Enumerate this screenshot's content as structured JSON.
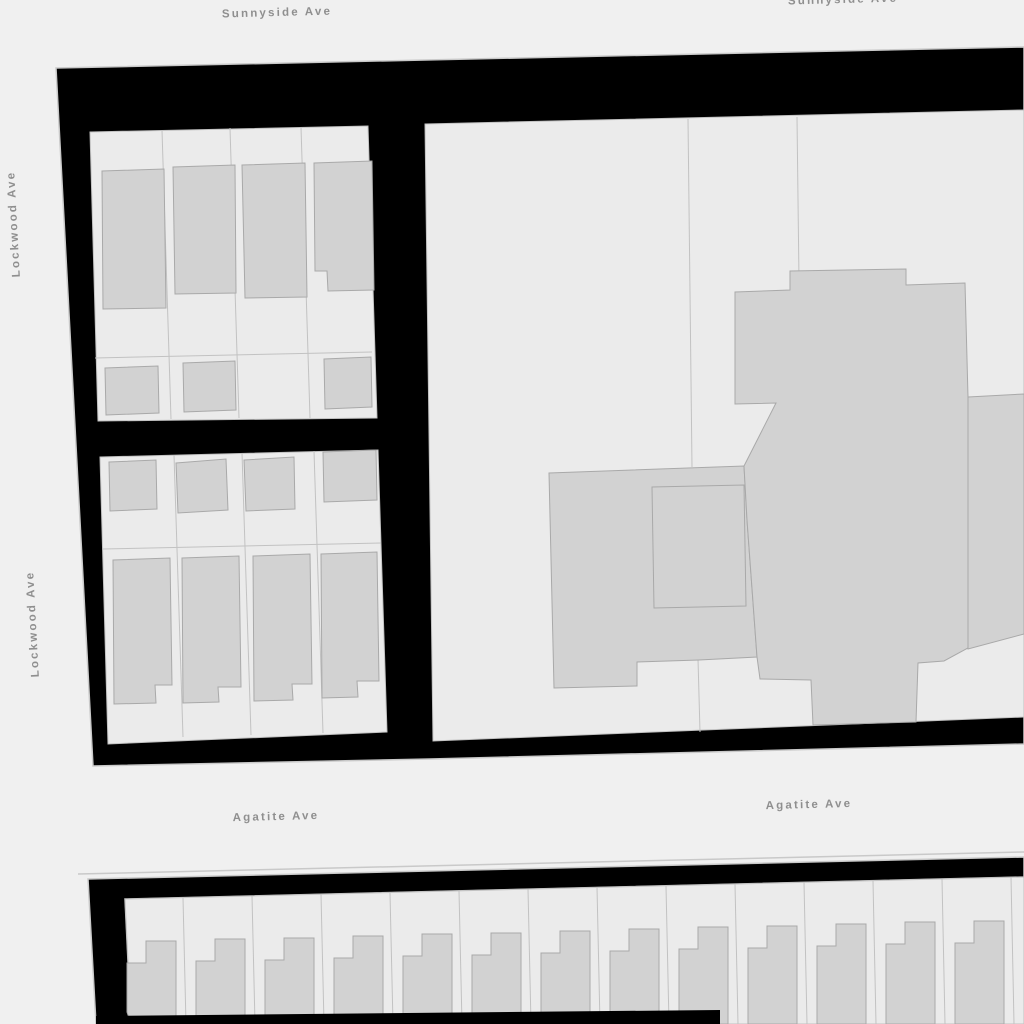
{
  "map": {
    "width": 1024,
    "height": 1024,
    "colors": {
      "background": "#f0f0f0",
      "block_fill": "#000000",
      "block_hairline": "#c9c9c9",
      "parcel_fill": "#ebebeb",
      "parcel_line": "#c2c2c2",
      "building_fill": "#d2d2d2",
      "building_line": "#a9a9a9",
      "label_text": "#8f8f8f",
      "label_halo": "#f0f0f0"
    },
    "styles": {
      "block": {
        "fill": "#000000",
        "stroke": "#c9c9c9",
        "sw": 1.5,
        "click": "true"
      },
      "strip": {
        "fill": "#000000",
        "stroke": "none",
        "sw": 0,
        "click": "false"
      },
      "parcelArea": {
        "fill": "#ebebeb",
        "stroke": "#c2c2c2",
        "sw": 1,
        "click": "true"
      },
      "parcelLine": {
        "fill": "none",
        "stroke": "#c2c2c2",
        "sw": 1,
        "click": "false"
      },
      "building": {
        "fill": "#d2d2d2",
        "stroke": "#a9a9a9",
        "sw": 1,
        "click": "true"
      },
      "buildingInner": {
        "fill": "none",
        "stroke": "#a9a9a9",
        "sw": 1,
        "click": "false"
      },
      "hairline": {
        "fill": "none",
        "stroke": "#c9c9c9",
        "sw": 1.5,
        "click": "false"
      }
    },
    "street_labels": [
      {
        "text": "Sunnyside Ave",
        "x": 277,
        "y": 13,
        "rotate": -1.5
      },
      {
        "text": "Sunnyside Ave",
        "x": 843,
        "y": 0,
        "rotate": -1.5
      },
      {
        "text": "Lockwood Ave",
        "x": 14,
        "y": 224,
        "rotate": -93
      },
      {
        "text": "Lockwood Ave",
        "x": 33,
        "y": 624,
        "rotate": -93
      },
      {
        "text": "Agatite Ave",
        "x": 276,
        "y": 817,
        "rotate": -1.5
      },
      {
        "text": "Agatite Ave",
        "x": 809,
        "y": 805,
        "rotate": -1.5
      }
    ],
    "layers": [
      {
        "type": "polygon",
        "role": "block",
        "name": "city-block-north",
        "points": "56,68 1024,47 1024,744 430,759 93,766"
      },
      {
        "type": "polygon",
        "role": "parcelArea",
        "name": "parcel-grid-nw-upper",
        "points": "90,132 368,126 377,418 98,421"
      },
      {
        "type": "polygon",
        "role": "parcelArea",
        "name": "parcel-grid-nw-lower",
        "points": "100,457 378,450 387,732 108,744"
      },
      {
        "type": "polygon",
        "role": "parcelArea",
        "name": "parcel-grid-ne",
        "points": "425,124 1024,110 1024,717 433,741"
      },
      {
        "type": "line",
        "role": "parcelLine",
        "name": "parcel-line",
        "x1": 162,
        "y1": 130,
        "x2": 171,
        "y2": 419
      },
      {
        "type": "line",
        "role": "parcelLine",
        "name": "parcel-line",
        "x1": 230,
        "y1": 128,
        "x2": 239,
        "y2": 418
      },
      {
        "type": "line",
        "role": "parcelLine",
        "name": "parcel-line",
        "x1": 301,
        "y1": 127,
        "x2": 310,
        "y2": 418
      },
      {
        "type": "line",
        "role": "parcelLine",
        "name": "parcel-line",
        "x1": 95,
        "y1": 358,
        "x2": 372,
        "y2": 352
      },
      {
        "type": "line",
        "role": "parcelLine",
        "name": "parcel-line",
        "x1": 174,
        "y1": 455,
        "x2": 183,
        "y2": 737
      },
      {
        "type": "line",
        "role": "parcelLine",
        "name": "parcel-line",
        "x1": 242,
        "y1": 453,
        "x2": 251,
        "y2": 735
      },
      {
        "type": "line",
        "role": "parcelLine",
        "name": "parcel-line",
        "x1": 314,
        "y1": 451,
        "x2": 323,
        "y2": 733
      },
      {
        "type": "line",
        "role": "parcelLine",
        "name": "parcel-line",
        "x1": 103,
        "y1": 549,
        "x2": 381,
        "y2": 543
      },
      {
        "type": "line",
        "role": "parcelLine",
        "name": "parcel-line",
        "x1": 688,
        "y1": 119,
        "x2": 692,
        "y2": 467
      },
      {
        "type": "line",
        "role": "parcelLine",
        "name": "parcel-line",
        "x1": 797,
        "y1": 117,
        "x2": 799,
        "y2": 281
      },
      {
        "type": "line",
        "role": "parcelLine",
        "name": "parcel-line",
        "x1": 698,
        "y1": 659,
        "x2": 700,
        "y2": 732
      },
      {
        "type": "polygon",
        "role": "building",
        "name": "building-footprint",
        "points": "102,171 164,169 166,308 103,309"
      },
      {
        "type": "polygon",
        "role": "building",
        "name": "building-footprint",
        "points": "173,167 235,165 236,293 175,294"
      },
      {
        "type": "polygon",
        "role": "building",
        "name": "building-footprint",
        "points": "242,165 305,163 307,297 245,298"
      },
      {
        "type": "polygon",
        "role": "building",
        "name": "building-footprint",
        "points": "314,163 372,161 374,290 328,291 327,271 315,271"
      },
      {
        "type": "polygon",
        "role": "building",
        "name": "garage-footprint",
        "points": "105,368 158,366 159,413 106,415"
      },
      {
        "type": "polygon",
        "role": "building",
        "name": "garage-footprint",
        "points": "183,363 235,361 236,410 184,412"
      },
      {
        "type": "polygon",
        "role": "building",
        "name": "garage-footprint",
        "points": "324,359 371,357 372,407 325,409"
      },
      {
        "type": "polygon",
        "role": "building",
        "name": "garage-footprint",
        "points": "109,462 156,460 157,509 110,511"
      },
      {
        "type": "polygon",
        "role": "building",
        "name": "garage-footprint",
        "points": "176,463 226,459 228,510 178,513"
      },
      {
        "type": "polygon",
        "role": "building",
        "name": "garage-footprint",
        "points": "244,460 294,457 295,509 246,511"
      },
      {
        "type": "polygon",
        "role": "building",
        "name": "garage-footprint",
        "points": "323,452 376,450 377,500 324,502"
      },
      {
        "type": "polygon",
        "role": "building",
        "name": "building-footprint",
        "points": "113,560 170,558 172,685 155,685 156,703 114,704"
      },
      {
        "type": "polygon",
        "role": "building",
        "name": "building-footprint",
        "points": "182,558 239,556 241,687 218,687 219,702 183,703"
      },
      {
        "type": "polygon",
        "role": "building",
        "name": "building-footprint",
        "points": "253,556 310,554 312,684 292,684 293,700 254,701"
      },
      {
        "type": "polygon",
        "role": "building",
        "name": "building-footprint",
        "points": "321,554 377,552 379,681 357,681 358,697 322,698"
      },
      {
        "type": "polygon",
        "role": "building",
        "name": "building-footprint-courtyard",
        "points": "549,473 744,466 747,520 757,657 699,660 637,662 637,686 554,688"
      },
      {
        "type": "polygon",
        "role": "building",
        "name": "building-footprint-large",
        "points": "735,292 790,290 790,271 906,269 906,285 965,283 968,397 968,648 944,661 918,663 916,722 813,725 811,680 760,679 757,657 747,520 744,466 776,403 735,404"
      },
      {
        "type": "polygon",
        "role": "building",
        "name": "building-footprint-wing",
        "points": "968,397 1024,394 1024,634 968,649"
      },
      {
        "type": "polygon",
        "role": "buildingInner",
        "name": "building-courtyard-outline",
        "points": "652,487 744,485 746,606 654,608"
      },
      {
        "type": "line",
        "role": "hairline",
        "name": "block-edge-hairline",
        "x1": 78,
        "y1": 874,
        "x2": 1024,
        "y2": 852
      },
      {
        "type": "polygon",
        "role": "block",
        "name": "city-block-south",
        "points": "88,879 1024,857 1024,877 125,899 131,1024 96,1024"
      },
      {
        "type": "polygon",
        "role": "parcelArea",
        "name": "parcel-row-south",
        "points": "125,899 1024,877 1024,1024 131,1024"
      },
      {
        "type": "line",
        "role": "parcelLine",
        "name": "parcel-line",
        "x1": 183,
        "y1": 898,
        "x2": 186,
        "y2": 1024
      },
      {
        "type": "line",
        "role": "parcelLine",
        "name": "parcel-line",
        "x1": 252,
        "y1": 896,
        "x2": 255,
        "y2": 1024
      },
      {
        "type": "line",
        "role": "parcelLine",
        "name": "parcel-line",
        "x1": 321,
        "y1": 894,
        "x2": 324,
        "y2": 1024
      },
      {
        "type": "line",
        "role": "parcelLine",
        "name": "parcel-line",
        "x1": 390,
        "y1": 893,
        "x2": 393,
        "y2": 1024
      },
      {
        "type": "line",
        "role": "parcelLine",
        "name": "parcel-line",
        "x1": 459,
        "y1": 891,
        "x2": 462,
        "y2": 1024
      },
      {
        "type": "line",
        "role": "parcelLine",
        "name": "parcel-line",
        "x1": 528,
        "y1": 889,
        "x2": 531,
        "y2": 1024
      },
      {
        "type": "line",
        "role": "parcelLine",
        "name": "parcel-line",
        "x1": 597,
        "y1": 887,
        "x2": 600,
        "y2": 1024
      },
      {
        "type": "line",
        "role": "parcelLine",
        "name": "parcel-line",
        "x1": 666,
        "y1": 886,
        "x2": 669,
        "y2": 1024
      },
      {
        "type": "line",
        "role": "parcelLine",
        "name": "parcel-line",
        "x1": 735,
        "y1": 884,
        "x2": 738,
        "y2": 1024
      },
      {
        "type": "line",
        "role": "parcelLine",
        "name": "parcel-line",
        "x1": 804,
        "y1": 882,
        "x2": 807,
        "y2": 1024
      },
      {
        "type": "line",
        "role": "parcelLine",
        "name": "parcel-line",
        "x1": 873,
        "y1": 881,
        "x2": 876,
        "y2": 1024
      },
      {
        "type": "line",
        "role": "parcelLine",
        "name": "parcel-line",
        "x1": 942,
        "y1": 879,
        "x2": 945,
        "y2": 1024
      },
      {
        "type": "line",
        "role": "parcelLine",
        "name": "parcel-line",
        "x1": 1011,
        "y1": 877,
        "x2": 1014,
        "y2": 1024
      },
      {
        "type": "polygon",
        "role": "building",
        "name": "building-footprint",
        "points": "127,963 146,963 146,941 176,941 176,1024 131,1024 127,1012"
      },
      {
        "type": "polygon",
        "role": "building",
        "name": "building-footprint",
        "points": "196,961 215,961 215,939 245,939 245,1024 196,1024"
      },
      {
        "type": "polygon",
        "role": "building",
        "name": "building-footprint",
        "points": "265,960 284,960 284,938 314,938 314,1024 265,1024"
      },
      {
        "type": "polygon",
        "role": "building",
        "name": "building-footprint",
        "points": "334,958 353,958 353,936 383,936 383,1024 334,1024"
      },
      {
        "type": "polygon",
        "role": "building",
        "name": "building-footprint",
        "points": "403,956 422,956 422,934 452,934 452,1024 403,1024"
      },
      {
        "type": "polygon",
        "role": "building",
        "name": "building-footprint",
        "points": "472,955 491,955 491,933 521,933 521,1024 472,1024"
      },
      {
        "type": "polygon",
        "role": "building",
        "name": "building-footprint",
        "points": "541,953 560,953 560,931 590,931 590,1024 541,1024"
      },
      {
        "type": "polygon",
        "role": "building",
        "name": "building-footprint",
        "points": "610,951 629,951 629,929 659,929 659,1024 610,1024"
      },
      {
        "type": "polygon",
        "role": "building",
        "name": "building-footprint",
        "points": "679,949 698,949 698,927 728,927 728,1024 679,1024"
      },
      {
        "type": "polygon",
        "role": "building",
        "name": "building-footprint",
        "points": "748,948 767,948 767,926 797,926 797,1024 748,1024"
      },
      {
        "type": "polygon",
        "role": "building",
        "name": "building-footprint",
        "points": "817,946 836,946 836,924 866,924 866,1024 817,1024"
      },
      {
        "type": "polygon",
        "role": "building",
        "name": "building-footprint",
        "points": "886,944 905,944 905,922 935,922 935,1024 886,1024"
      },
      {
        "type": "polygon",
        "role": "building",
        "name": "building-footprint",
        "points": "955,943 974,943 974,921 1004,921 1004,1024 955,1024"
      },
      {
        "type": "polygon",
        "role": "strip",
        "name": "alley-strip-south",
        "points": "96,1016 720,1010 720,1024 96,1024"
      }
    ]
  }
}
